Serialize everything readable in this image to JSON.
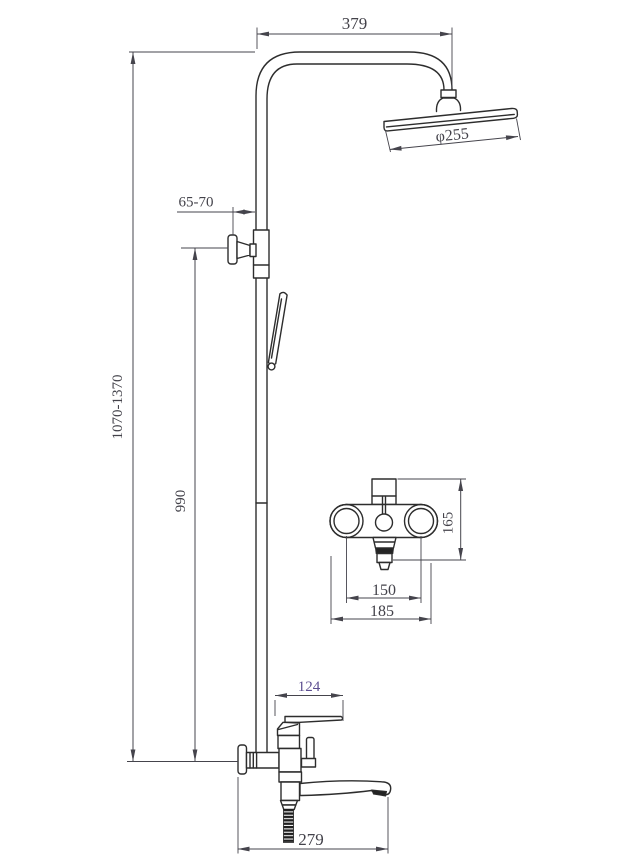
{
  "drawing": {
    "kind": "technical dimension drawing",
    "subject": "shower column with overhead rain shower, hand shower, wall-mount mixer and bath spout",
    "background_color": "#ffffff",
    "line_color": "#2d2d2d",
    "dimension_color": "#45444c",
    "highlight_dimension_color": "#5d4f91",
    "dimensions": {
      "arm_width": "379",
      "head_diameter": "φ255",
      "bracket_offset": "65-70",
      "total_height_range": "1070-1370",
      "riser_height": "990",
      "mixer_body_height": "165",
      "mixer_hole_spacing": "150",
      "mixer_overall_width": "185",
      "handle_length": "124",
      "spout_reach": "279"
    }
  }
}
